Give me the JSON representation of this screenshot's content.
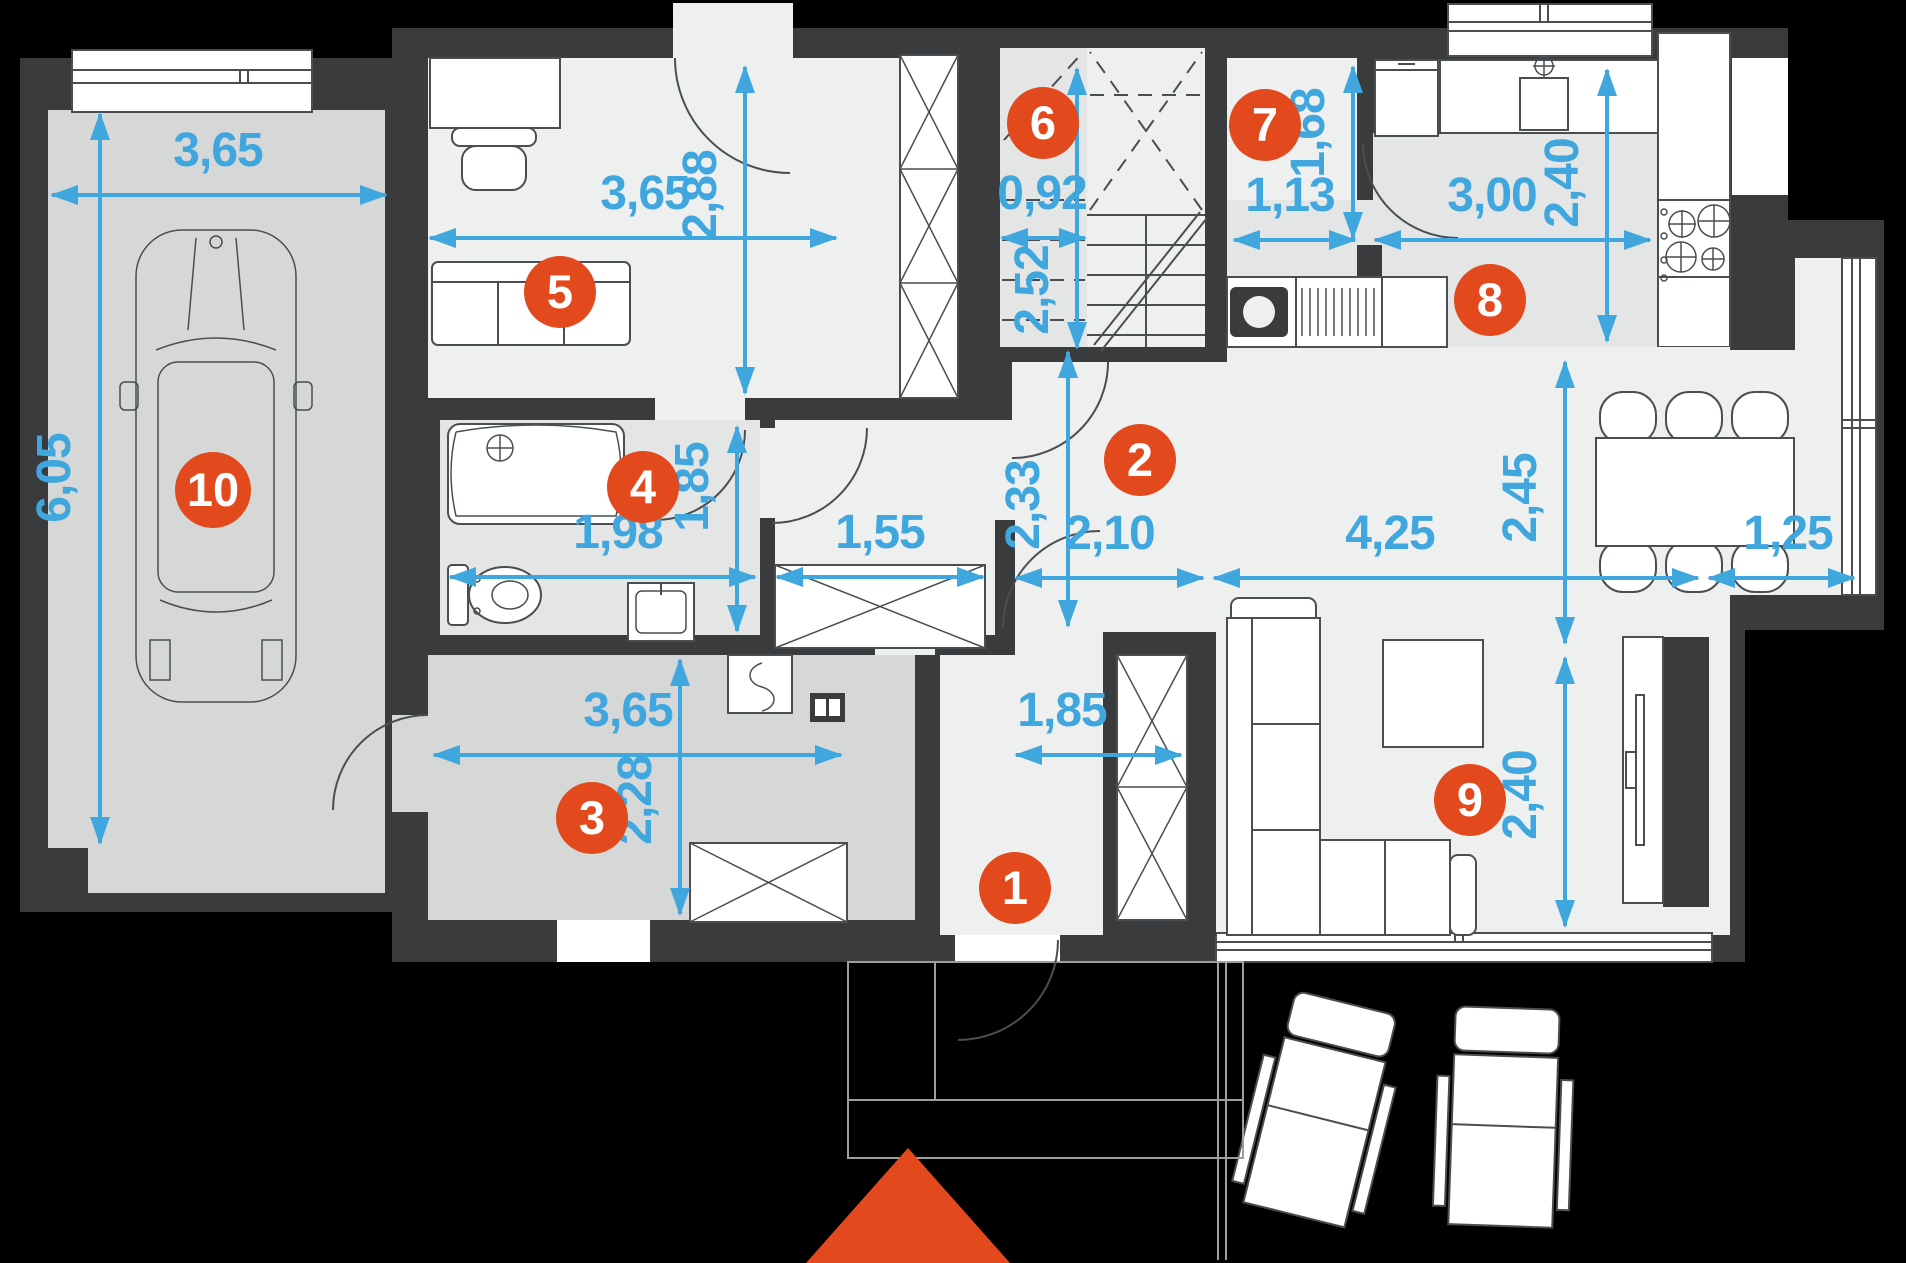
{
  "plan": {
    "type": "floor-plan",
    "rooms": [
      {
        "number": "1",
        "name": "entry-hall"
      },
      {
        "number": "2",
        "name": "hallway"
      },
      {
        "number": "3",
        "name": "utility-room"
      },
      {
        "number": "4",
        "name": "bathroom"
      },
      {
        "number": "5",
        "name": "office-room"
      },
      {
        "number": "6",
        "name": "staircase"
      },
      {
        "number": "7",
        "name": "pantry"
      },
      {
        "number": "8",
        "name": "kitchen"
      },
      {
        "number": "9",
        "name": "living-room"
      },
      {
        "number": "10",
        "name": "garage"
      }
    ],
    "dimensions": {
      "garage_w": "3,65",
      "garage_d": "6,05",
      "office_w": "3,65",
      "office_d": "2,88",
      "stairs_w": "0,92",
      "stairs_d": "2,52",
      "pantry_w": "1,13",
      "pantry_d": "1,68",
      "kitchen_w": "3,00",
      "kitchen_d": "2,40",
      "bath_w": "1,98",
      "bath_d": "1,85",
      "closet_w": "1,55",
      "hall_d": "2,33",
      "hall_w": "2,10",
      "dining_w": "4,25",
      "dining_d": "2,45",
      "bay_w": "1,25",
      "living_d": "2,40",
      "utility_w": "3,65",
      "utility_d": "2,28",
      "entry_w": "1,85"
    },
    "colors": {
      "outside": "#000000",
      "wall": "#3a3b3d",
      "floor_light": "#eef0f0",
      "floor_mid": "#e4e6e6",
      "floor_dark": "#d6d8d8",
      "dimension_blue": "#3fa7de",
      "accent_orange": "#e2491c"
    }
  }
}
